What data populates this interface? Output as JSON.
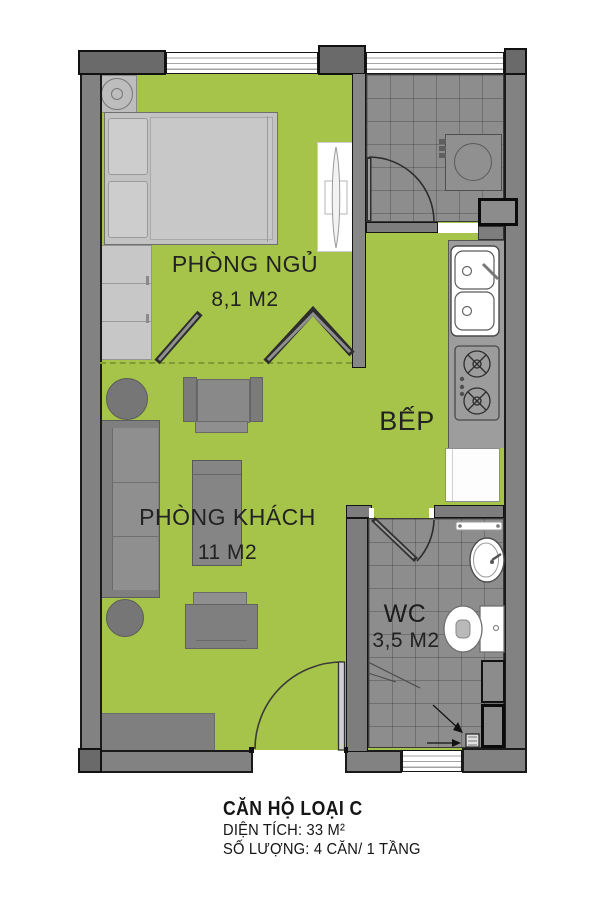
{
  "plan": {
    "rooms": [
      {
        "id": "bedroom",
        "name": "PHÒNG NGỦ",
        "area": "8,1 M2"
      },
      {
        "id": "living",
        "name": "PHÒNG KHÁCH",
        "area": "11 M2"
      },
      {
        "id": "kitchen",
        "name": "BẾP",
        "area": ""
      },
      {
        "id": "wc",
        "name": "WC",
        "area": "3,5 M2"
      }
    ]
  },
  "caption": {
    "title": "CĂN HỘ LOẠI C",
    "line2": "DIỆN TÍCH: 33 M²",
    "line3": "SỐ LƯỢNG: 4 CĂN/ 1 TẦNG"
  },
  "colors": {
    "floor_green": "#a7c44a",
    "wall_gray": "#828282",
    "wall_dark_gray": "#6a6a6a",
    "interior_wall_gray": "#7d7d7d",
    "tile_gray": "#8d8d8d",
    "outline_black": "#161616",
    "furniture_gray": "#7f7f7f",
    "fixture_white": "#ffffff",
    "dash_green": "#7d9c31"
  }
}
